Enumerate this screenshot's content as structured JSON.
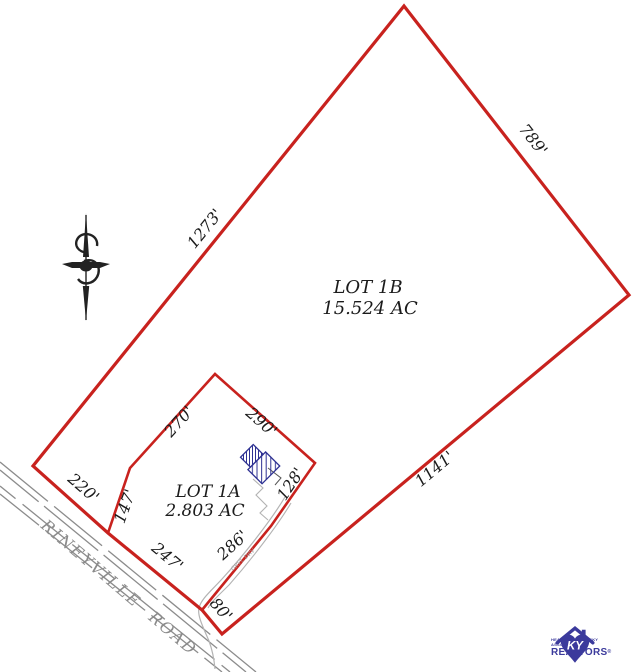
{
  "parcels": [
    {
      "name": "LOT 1B",
      "area": "15.524 AC"
    },
    {
      "name": "LOT 1A",
      "area": "2.803 AC"
    }
  ],
  "dims": {
    "d1273": "1273'",
    "d789": "789'",
    "d1141": "1141'",
    "d220": "220'",
    "d247": "247'",
    "d80": "80'",
    "d147": "147'",
    "d270": "270'",
    "d290": "290'",
    "d128": "128'",
    "d286": "286'"
  },
  "road": {
    "name": "RINEYVILLE ROAD"
  },
  "driveway": {
    "label": "GRVL DRV"
  },
  "logo": {
    "ky": "KY",
    "line1": "HEART OF KENTUCKY",
    "line2": "ASSOCIATION OF",
    "line3": "REALTORS",
    "registered": "®"
  },
  "colors": {
    "boundary": "#c8221e",
    "road": "#8c8c8c",
    "driveway": "#b3b3b3",
    "house": "#2e3192",
    "logo": "#3b3a9c",
    "text": "#1b1b1b",
    "north_arrow": "#222222"
  }
}
